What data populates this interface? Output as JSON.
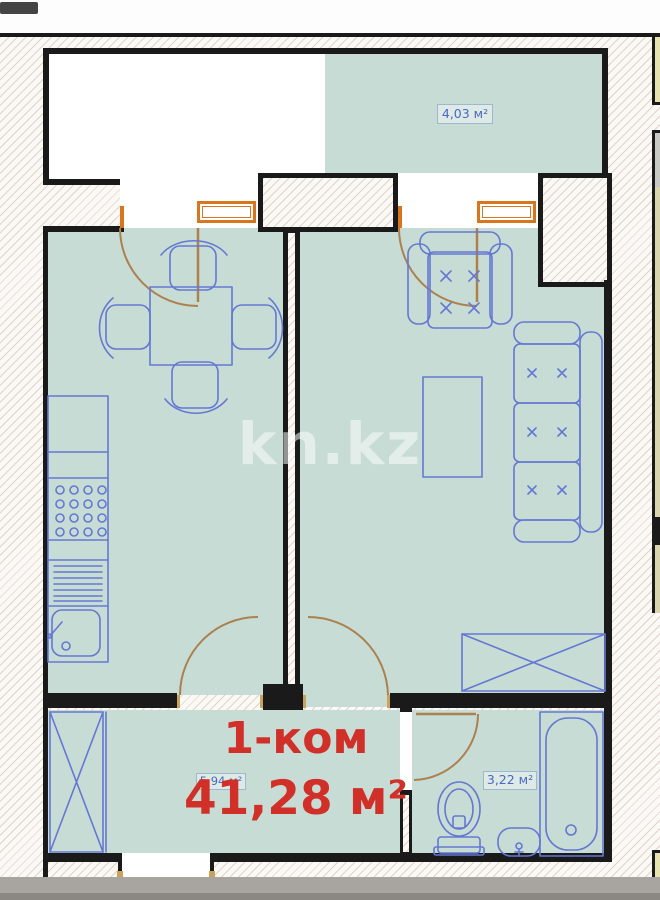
{
  "watermark": "kn.kz",
  "plan": {
    "rooms_label": "1-ком",
    "total_area": "41,28 м²",
    "balcony_area": "4,03 м²",
    "hallway_area": "5,94 м²",
    "bathroom_area": "3,22 м²"
  },
  "colors": {
    "floor_teal": "#c8dcd6",
    "wall_black": "#1a1a1a",
    "furniture_blue": "#6478d2",
    "label_blue": "#4968c8",
    "title_red": "#d03028",
    "window_orange": "#d9751c",
    "door_arc_tan": "#ab8150",
    "hatch_line": "#be9b8c",
    "photo_strip_gray": "#a19e9a"
  },
  "icons": [
    "dining-table-icon",
    "chair-icon",
    "kitchen-counter-icon",
    "stove-icon",
    "kitchen-sink-icon",
    "armchair-icon",
    "sofa-icon",
    "coffee-table-icon",
    "wardrobe-icon",
    "hall-closet-icon",
    "toilet-icon",
    "washbasin-icon",
    "bathtub-icon",
    "door-swing-icon",
    "balcony-window-icon"
  ]
}
